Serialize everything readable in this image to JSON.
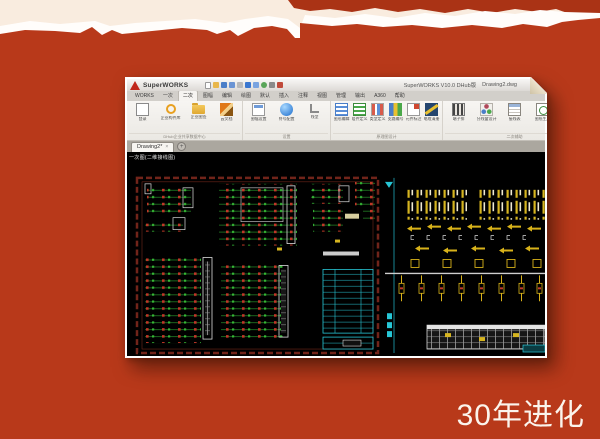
{
  "slide": {
    "caption": "30年进化",
    "background_color": "#b8391a",
    "paper_color": "#f9ecdf"
  },
  "window": {
    "app_title": "SuperWORKS",
    "title_right": "SuperWORKS V10.0 DHub版",
    "title_file": "Drawing2.dwg",
    "quick_access_icons": [
      "new-doc-icon",
      "open-folder-icon",
      "save-icon",
      "save-as-icon",
      "print-icon",
      "undo-icon",
      "redo-icon",
      "refresh-icon",
      "window-icon",
      "close-icon"
    ],
    "ribbon_tabs": [
      "WORKS",
      "一次",
      "二次",
      "图幅",
      "编辑",
      "绘图",
      "默认",
      "插入",
      "注释",
      "视图",
      "管理",
      "输出",
      "A360",
      "帮助"
    ],
    "active_tab_index": 2,
    "ribbon_groups": [
      {
        "name": "DHub企业共享数据中心",
        "compact": false,
        "items": [
          {
            "label": "登录",
            "icon": "panel"
          },
          {
            "label": "企业构件库",
            "icon": "ring"
          },
          {
            "label": "企业图签",
            "icon": "folder"
          },
          {
            "label": "云文档",
            "icon": "pen"
          }
        ]
      },
      {
        "name": "设置",
        "compact": false,
        "items": [
          {
            "label": "图幅设置",
            "icon": "frame"
          },
          {
            "label": "符号配置",
            "icon": "ball"
          },
          {
            "label": "线型",
            "icon": "lshape"
          }
        ]
      },
      {
        "name": "原理图设计",
        "compact": true,
        "items": [
          {
            "label": "图形编辑",
            "icon": "grid-blue"
          },
          {
            "label": "组件定义",
            "icon": "grid-green"
          },
          {
            "label": "类型定义",
            "icon": "grid-red"
          },
          {
            "label": "支路编号",
            "icon": "flag"
          },
          {
            "label": "元件标注",
            "icon": "tag"
          },
          {
            "label": "电缆清册",
            "icon": "cable"
          }
        ]
      },
      {
        "name": "二次辅助",
        "compact": false,
        "items": [
          {
            "label": "端子排",
            "icon": "term"
          },
          {
            "label": "分线盒设计",
            "icon": "tree"
          },
          {
            "label": "接线表",
            "icon": "table"
          },
          {
            "label": "图纸生成",
            "icon": "gen"
          },
          {
            "label": "报表输出",
            "icon": "table"
          }
        ]
      }
    ],
    "overflow_icons": [
      "mini-table-icon",
      "mini-grid-icon",
      "mini-list-icon"
    ],
    "file_tab": {
      "label": "Drawing2*",
      "close": "×",
      "new_tab": "+"
    },
    "canvas_caption": "一次图(二维接线图)"
  }
}
